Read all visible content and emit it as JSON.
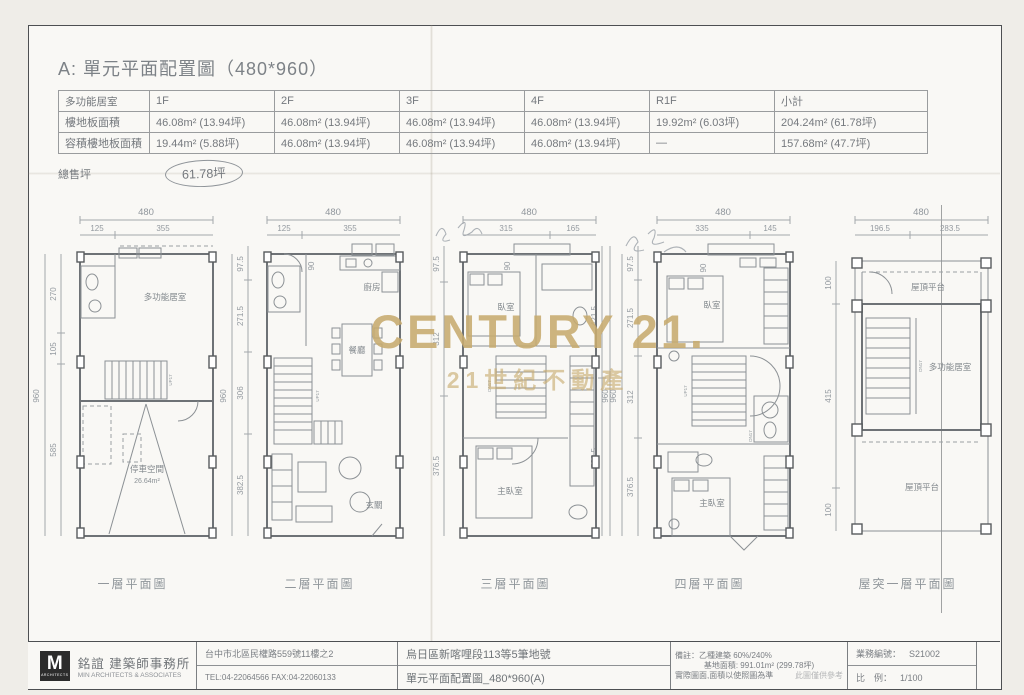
{
  "page": {
    "title": "A: 單元平面配置圖（480*960）"
  },
  "watermark": {
    "line1": "CENTURY 21.",
    "line2": "21世紀不動產",
    "color": "#c8ab6f"
  },
  "area_table": {
    "corner": "多功能居室",
    "cols": [
      "1F",
      "2F",
      "3F",
      "4F",
      "R1F",
      "小計"
    ],
    "rows": [
      {
        "label": "樓地板面積",
        "values": [
          "46.08m² (13.94坪)",
          "46.08m² (13.94坪)",
          "46.08m² (13.94坪)",
          "46.08m² (13.94坪)",
          "19.92m² (6.03坪)",
          "204.24m² (61.78坪)"
        ]
      },
      {
        "label": "容積樓地板面積",
        "values": [
          "19.44m² (5.88坪)",
          "46.08m² (13.94坪)",
          "46.08m² (13.94坪)",
          "46.08m² (13.94坪)",
          "—",
          "157.68m² (47.7坪)"
        ]
      }
    ],
    "total_label": "總售坪",
    "total_value": "61.78坪"
  },
  "stair": {
    "up": "UP17",
    "dn": "DN17"
  },
  "plans": [
    {
      "label": "一層平面圖",
      "top_total": "480",
      "top_a": "125",
      "top_b": "355",
      "side": [
        "270",
        "105",
        "585"
      ],
      "overall": "960",
      "room_a": "多功能居室",
      "room_b": "停車空間",
      "room_b_area": "26.64m²"
    },
    {
      "label": "二層平面圖",
      "top_total": "480",
      "top_a": "125",
      "top_b": "355",
      "side": [
        "97.5",
        "271.5",
        "306",
        "382.5"
      ],
      "overall": "960",
      "offset": "90",
      "room_a": "廚房",
      "room_b": "餐廳",
      "room_c": "玄關"
    },
    {
      "label": "三層平面圖",
      "top_total": "480",
      "top_a": "315",
      "top_b": "165",
      "side": [
        "97.5",
        "312",
        "376.5"
      ],
      "right": [
        "421.5",
        "538.5"
      ],
      "overall": "960",
      "offset": "90",
      "room_a": "臥室",
      "room_b": "主臥室"
    },
    {
      "label": "四層平面圖",
      "top_total": "480",
      "top_a": "335",
      "top_b": "145",
      "side": [
        "97.5",
        "271.5",
        "312",
        "376.5"
      ],
      "overall": "960",
      "offset": "90",
      "room_a": "臥室",
      "room_b": "主臥室"
    },
    {
      "label": "屋突一層平面圖",
      "top_total": "480",
      "top_a": "196.5",
      "top_b": "283.5",
      "side": [
        "100",
        "415",
        "100"
      ],
      "room_a": "屋頂平台",
      "room_b": "多功能居室",
      "room_c": "屋頂平台"
    }
  ],
  "titleblock": {
    "logo_letter": "M",
    "logo_caption": "ARCHITECTS",
    "firm_cn": "銘誼 建築師事務所",
    "firm_en": "MIN ARCHITECTS & ASSOCIATES",
    "address": "台中市北區民權路559號11樓之2",
    "tel_fax": "TEL:04-22064566  FAX:04-22060133",
    "site": "烏日區新喀哩段113等5筆地號",
    "drawing": "單元平面配置圖_480*960(A)",
    "note_label": "備註：",
    "note1": "乙種建築 60%/240%",
    "note2": "基地面積: 991.01m² (299.78坪)",
    "note3": "實際圖面,面積以使照圖為準",
    "note4": "此圖僅供參考",
    "job_label": "業務編號：",
    "job_no": "S21002",
    "scale_label": "比　例：",
    "scale": "1/100"
  }
}
